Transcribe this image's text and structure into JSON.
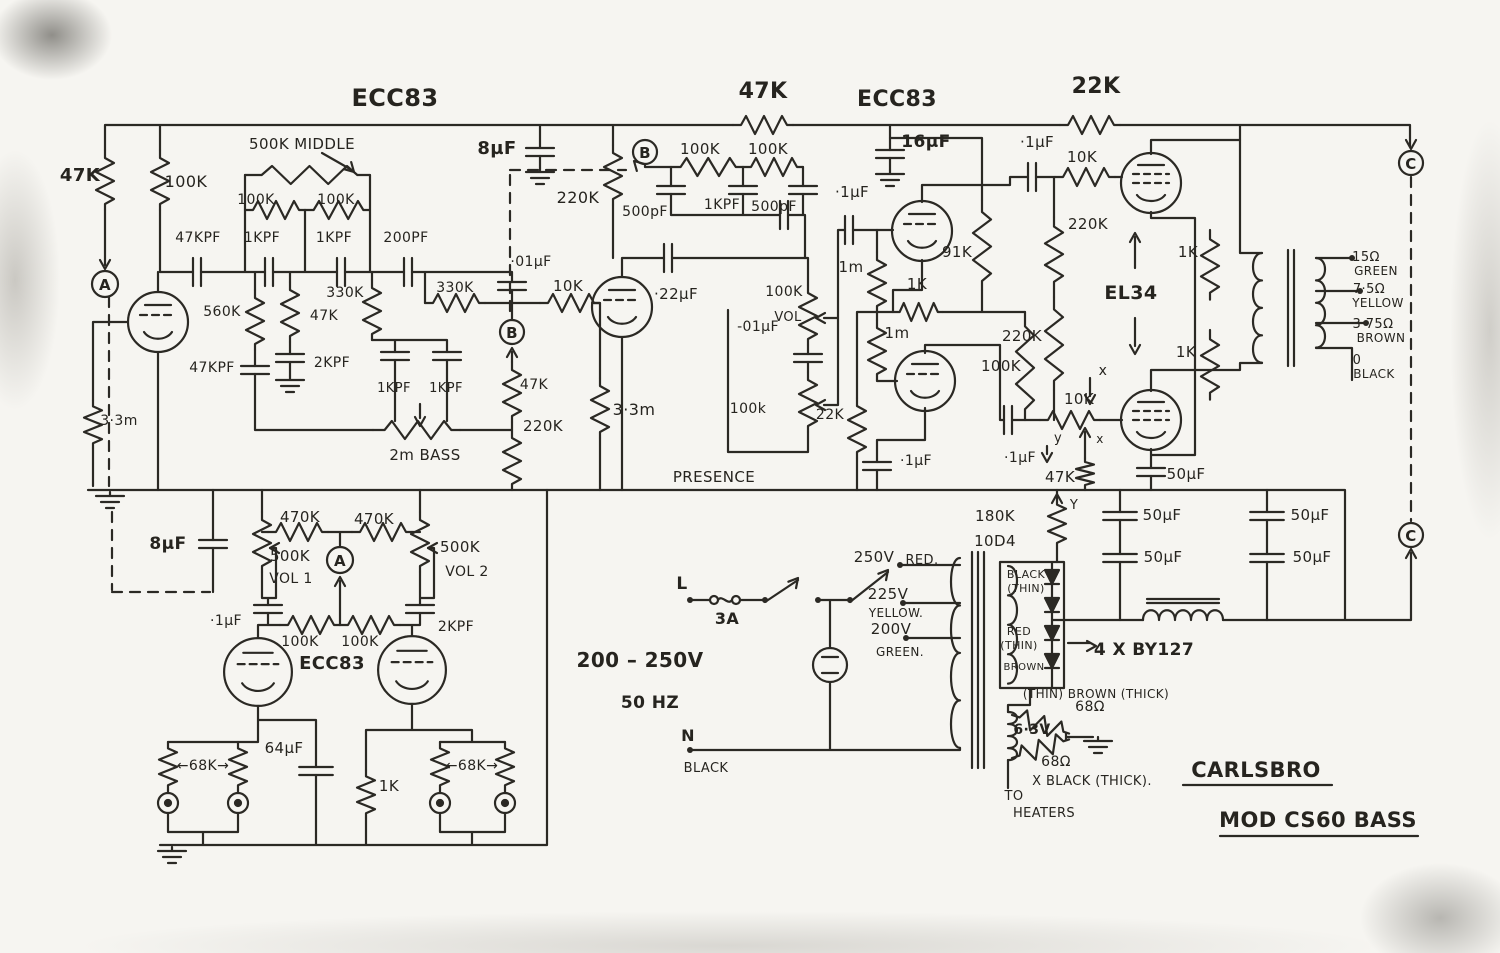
{
  "meta": {
    "drawing": "hand-drawn tube amplifier schematic",
    "brand": "CARLSBRO",
    "model": "MOD CS60 BASS"
  },
  "colors": {
    "ink": "#2b2924",
    "paper": "#f6f5f1",
    "edge_smudge": "#9a968f"
  },
  "labels": [
    {
      "n": "title-ecc83-1",
      "t": "ECC83",
      "x": 395,
      "y": 106,
      "s": 24,
      "b": 1
    },
    {
      "n": "r-47k-coupling-top",
      "t": "47K",
      "x": 763,
      "y": 98,
      "s": 22,
      "b": 1
    },
    {
      "n": "title-ecc83-2",
      "t": "ECC83",
      "x": 897,
      "y": 106,
      "s": 22,
      "b": 1
    },
    {
      "n": "r-22k-top",
      "t": "22K",
      "x": 1096,
      "y": 93,
      "s": 22,
      "b": 1
    },
    {
      "n": "r-47k-input",
      "t": "47K",
      "x": 80,
      "y": 181,
      "s": 18,
      "b": 1
    },
    {
      "n": "r-100k-v1-anode",
      "t": "100K",
      "x": 186,
      "y": 187,
      "s": 16
    },
    {
      "n": "pot-500k-middle",
      "t": "500K MIDDLE",
      "x": 302,
      "y": 149,
      "s": 15
    },
    {
      "n": "r-100k-mid-1",
      "t": "100K",
      "x": 256,
      "y": 204,
      "s": 14
    },
    {
      "n": "r-100k-mid-2",
      "t": "100K",
      "x": 336,
      "y": 204,
      "s": 14
    },
    {
      "n": "c-47kpf",
      "t": "47KPF",
      "x": 198,
      "y": 242,
      "s": 14
    },
    {
      "n": "c-1kpf-1",
      "t": "1KPF",
      "x": 262,
      "y": 242,
      "s": 14
    },
    {
      "n": "c-1kpf-2",
      "t": "1KPF",
      "x": 334,
      "y": 242,
      "s": 14
    },
    {
      "n": "c-200pf",
      "t": "200PF",
      "x": 406,
      "y": 242,
      "s": 14
    },
    {
      "n": "r-560k",
      "t": "560K",
      "x": 222,
      "y": 316,
      "s": 14
    },
    {
      "n": "r-330k-v",
      "t": "330K",
      "x": 345,
      "y": 297,
      "s": 14
    },
    {
      "n": "r-330k-h",
      "t": "330K",
      "x": 455,
      "y": 292,
      "s": 14
    },
    {
      "n": "r-47k-v1",
      "t": "47K",
      "x": 324,
      "y": 320,
      "s": 14
    },
    {
      "n": "c-47kpf-2",
      "t": "47KPF",
      "x": 212,
      "y": 372,
      "s": 14
    },
    {
      "n": "c-2kpf-1",
      "t": "2KPF",
      "x": 332,
      "y": 367,
      "s": 14
    },
    {
      "n": "c-8uf-1",
      "t": "8µF",
      "x": 497,
      "y": 154,
      "s": 18,
      "b": 1
    },
    {
      "n": "r-220k-b",
      "t": "220K",
      "x": 578,
      "y": 203,
      "s": 16
    },
    {
      "n": "c-01uf-b",
      "t": "·01µF",
      "x": 531,
      "y": 266,
      "s": 14
    },
    {
      "n": "r-10k-v2-grid",
      "t": "10K",
      "x": 568,
      "y": 291,
      "s": 15
    },
    {
      "n": "c-1kpf-3",
      "t": "1KPF",
      "x": 394,
      "y": 392,
      "s": 13
    },
    {
      "n": "c-1kpf-4",
      "t": "1KPF",
      "x": 446,
      "y": 392,
      "s": 13
    },
    {
      "n": "pot-2m-bass",
      "t": "2m BASS",
      "x": 425,
      "y": 460,
      "s": 15
    },
    {
      "n": "r-47k-b",
      "t": "47K",
      "x": 534,
      "y": 389,
      "s": 14
    },
    {
      "n": "r-220k-b2",
      "t": "220K",
      "x": 543,
      "y": 431,
      "s": 15
    },
    {
      "n": "r-3m3-input",
      "t": "3·3m",
      "x": 119,
      "y": 425,
      "s": 14
    },
    {
      "n": "r-3m3-v2",
      "t": "3·3m",
      "x": 634,
      "y": 415,
      "s": 16
    },
    {
      "n": "c-22uf",
      "t": "·22µF",
      "x": 676,
      "y": 299,
      "s": 15
    },
    {
      "n": "r-100k-b1",
      "t": "100K",
      "x": 700,
      "y": 154,
      "s": 15
    },
    {
      "n": "r-100k-b2",
      "t": "100K",
      "x": 768,
      "y": 154,
      "s": 15
    },
    {
      "n": "c-500pf-1",
      "t": "500pF",
      "x": 645,
      "y": 216,
      "s": 14
    },
    {
      "n": "c-1kpf-5",
      "t": "1KPF",
      "x": 722,
      "y": 209,
      "s": 14
    },
    {
      "n": "c-500pf-2",
      "t": "500pF",
      "x": 774,
      "y": 211,
      "s": 14
    },
    {
      "n": "c-01uf-presence",
      "t": "-01µF",
      "x": 758,
      "y": 331,
      "s": 14
    },
    {
      "n": "pot-100k-vol-upper",
      "t": "100K",
      "x": 784,
      "y": 296,
      "s": 14
    },
    {
      "n": "pot-vol-label",
      "t": "VOL",
      "x": 788,
      "y": 321,
      "s": 13
    },
    {
      "n": "pot-100k-presence",
      "t": "100k",
      "x": 748,
      "y": 413,
      "s": 14
    },
    {
      "n": "label-presence",
      "t": "PRESENCE",
      "x": 714,
      "y": 482,
      "s": 15
    },
    {
      "n": "r-22k-nfb",
      "t": "22K",
      "x": 830,
      "y": 419,
      "s": 14
    },
    {
      "n": "c-1uf-cathode",
      "t": "·1µF",
      "x": 916,
      "y": 465,
      "s": 14
    },
    {
      "n": "c-1uf-v3-grid",
      "t": "·1µF",
      "x": 852,
      "y": 197,
      "s": 15
    },
    {
      "n": "r-1m-1",
      "t": "1m",
      "x": 851,
      "y": 272,
      "s": 15
    },
    {
      "n": "r-91k",
      "t": "91K",
      "x": 957,
      "y": 257,
      "s": 15
    },
    {
      "n": "r-1k-pi",
      "t": "1K",
      "x": 917,
      "y": 289,
      "s": 15
    },
    {
      "n": "r-1m-2",
      "t": "1m",
      "x": 897,
      "y": 338,
      "s": 15
    },
    {
      "n": "c-16uf",
      "t": "16µF",
      "x": 926,
      "y": 147,
      "s": 17,
      "b": 1
    },
    {
      "n": "c-1uf-el34-1",
      "t": "·1µF",
      "x": 1037,
      "y": 147,
      "s": 15
    },
    {
      "n": "r-10k-el34-1",
      "t": "10K",
      "x": 1082,
      "y": 162,
      "s": 15
    },
    {
      "n": "r-220k-pi-1",
      "t": "220K",
      "x": 1088,
      "y": 229,
      "s": 15
    },
    {
      "n": "label-el34",
      "t": "EL34",
      "x": 1131,
      "y": 299,
      "s": 19,
      "b": 1
    },
    {
      "n": "r-220k-pi-2",
      "t": "220K",
      "x": 1022,
      "y": 341,
      "s": 15
    },
    {
      "n": "r-100k-pi",
      "t": "100K",
      "x": 1001,
      "y": 371,
      "s": 15
    },
    {
      "n": "c-1uf-el34-2",
      "t": "·1µF",
      "x": 1020,
      "y": 462,
      "s": 14
    },
    {
      "n": "pot-10k-bias",
      "t": "10K",
      "x": 1079,
      "y": 404,
      "s": 15
    },
    {
      "n": "label-x-1",
      "t": "x",
      "x": 1103,
      "y": 375,
      "s": 14
    },
    {
      "n": "label-x-2",
      "t": "x",
      "x": 1100,
      "y": 443,
      "s": 12
    },
    {
      "n": "label-y-1",
      "t": "y",
      "x": 1058,
      "y": 442,
      "s": 13
    },
    {
      "n": "r-47k-bias",
      "t": "47K",
      "x": 1060,
      "y": 482,
      "s": 15
    },
    {
      "n": "c-50uf-1",
      "t": "50µF",
      "x": 1186,
      "y": 479,
      "s": 15
    },
    {
      "n": "label-y-2",
      "t": "Y",
      "x": 1074,
      "y": 509,
      "s": 13
    },
    {
      "n": "r-180k",
      "t": "180K",
      "x": 995,
      "y": 521,
      "s": 15
    },
    {
      "n": "label-10d4",
      "t": "10D4",
      "x": 995,
      "y": 546,
      "s": 15
    },
    {
      "n": "c-50uf-2",
      "t": "50µF",
      "x": 1162,
      "y": 520,
      "s": 15
    },
    {
      "n": "c-50uf-3",
      "t": "50µF",
      "x": 1163,
      "y": 562,
      "s": 15
    },
    {
      "n": "c-50uf-4",
      "t": "50µF",
      "x": 1310,
      "y": 520,
      "s": 15
    },
    {
      "n": "c-50uf-5",
      "t": "50µF",
      "x": 1312,
      "y": 562,
      "s": 15
    },
    {
      "n": "r-1k-ot-1",
      "t": "1K",
      "x": 1188,
      "y": 257,
      "s": 15
    },
    {
      "n": "r-1k-ot-2",
      "t": "1K",
      "x": 1186,
      "y": 357,
      "s": 15
    },
    {
      "n": "tap-15ohm",
      "t": "15Ω",
      "x": 1366,
      "y": 261,
      "s": 13
    },
    {
      "n": "tap-green",
      "t": "GREEN",
      "x": 1376,
      "y": 275,
      "s": 12
    },
    {
      "n": "tap-7-5ohm",
      "t": "7·5Ω",
      "x": 1369,
      "y": 293,
      "s": 13
    },
    {
      "n": "tap-yellow",
      "t": "YELLOW",
      "x": 1378,
      "y": 307,
      "s": 12
    },
    {
      "n": "tap-3-75ohm",
      "t": "3·75Ω",
      "x": 1373,
      "y": 328,
      "s": 13
    },
    {
      "n": "tap-brown",
      "t": "BROWN",
      "x": 1381,
      "y": 342,
      "s": 12
    },
    {
      "n": "tap-0",
      "t": "0",
      "x": 1357,
      "y": 364,
      "s": 13
    },
    {
      "n": "tap-black",
      "t": "BLACK",
      "x": 1374,
      "y": 378,
      "s": 12
    },
    {
      "n": "node-c-1",
      "t": "C",
      "x": 1411,
      "y": 169,
      "s": 15,
      "b": 1
    },
    {
      "n": "node-c-2",
      "t": "C",
      "x": 1411,
      "y": 541,
      "s": 15,
      "b": 1
    },
    {
      "n": "node-a-1",
      "t": "A",
      "x": 105,
      "y": 290,
      "s": 15,
      "b": 1
    },
    {
      "n": "node-b-1",
      "t": "B",
      "x": 645,
      "y": 158,
      "s": 15,
      "b": 1
    },
    {
      "n": "node-b-2",
      "t": "B",
      "x": 512,
      "y": 338,
      "s": 15,
      "b": 1
    },
    {
      "n": "node-a-2",
      "t": "A",
      "x": 340,
      "y": 566,
      "s": 15,
      "b": 1
    },
    {
      "n": "c-8uf-2",
      "t": "8µF",
      "x": 168,
      "y": 549,
      "s": 17,
      "b": 1
    },
    {
      "n": "r-470k-1",
      "t": "470K",
      "x": 300,
      "y": 522,
      "s": 15
    },
    {
      "n": "r-470k-2",
      "t": "470K",
      "x": 374,
      "y": 524,
      "s": 15
    },
    {
      "n": "pot-500k-vol1",
      "t": "500K",
      "x": 290,
      "y": 561,
      "s": 15
    },
    {
      "n": "pot-vol1",
      "t": "VOL 1",
      "x": 291,
      "y": 583,
      "s": 14
    },
    {
      "n": "pot-500k-vol2",
      "t": "500K",
      "x": 460,
      "y": 552,
      "s": 15
    },
    {
      "n": "pot-vol2",
      "t": "VOL 2",
      "x": 467,
      "y": 576,
      "s": 14
    },
    {
      "n": "c-1uf-vol1",
      "t": "·1µF",
      "x": 226,
      "y": 625,
      "s": 14
    },
    {
      "n": "r-100k-g1",
      "t": "100K",
      "x": 300,
      "y": 646,
      "s": 14
    },
    {
      "n": "r-100k-g2",
      "t": "100K",
      "x": 360,
      "y": 646,
      "s": 14
    },
    {
      "n": "c-2kpf-2",
      "t": "2KPF",
      "x": 456,
      "y": 631,
      "s": 14
    },
    {
      "n": "title-ecc83-3",
      "t": "ECC83",
      "x": 332,
      "y": 669,
      "s": 18,
      "b": 1
    },
    {
      "n": "r-68k-left",
      "t": "←68K→",
      "x": 203,
      "y": 770,
      "s": 14
    },
    {
      "n": "r-68k-right",
      "t": "←68K→",
      "x": 472,
      "y": 770,
      "s": 14
    },
    {
      "n": "c-64uf",
      "t": "64µF",
      "x": 284,
      "y": 753,
      "s": 15
    },
    {
      "n": "r-1k-cathode",
      "t": "1K",
      "x": 389,
      "y": 791,
      "s": 15
    },
    {
      "n": "label-l",
      "t": "L",
      "x": 682,
      "y": 589,
      "s": 17,
      "b": 1
    },
    {
      "n": "label-3a",
      "t": "3A",
      "x": 727,
      "y": 624,
      "s": 16,
      "b": 1
    },
    {
      "n": "label-mains-v",
      "t": "200 – 250V",
      "x": 640,
      "y": 667,
      "s": 20,
      "b": 1
    },
    {
      "n": "label-50hz",
      "t": "50 HZ",
      "x": 650,
      "y": 708,
      "s": 17,
      "b": 1
    },
    {
      "n": "label-n",
      "t": "N",
      "x": 688,
      "y": 741,
      "s": 16,
      "b": 1
    },
    {
      "n": "label-black-mains",
      "t": "BLACK",
      "x": 706,
      "y": 772,
      "s": 13
    },
    {
      "n": "tap-250v",
      "t": "250V",
      "x": 874,
      "y": 562,
      "s": 15
    },
    {
      "n": "tap-red",
      "t": "RED.",
      "x": 922,
      "y": 564,
      "s": 13
    },
    {
      "n": "tap-225v",
      "t": "225V",
      "x": 888,
      "y": 599,
      "s": 15
    },
    {
      "n": "tap-yellow-psu",
      "t": "YELLOW.",
      "x": 896,
      "y": 617,
      "s": 12
    },
    {
      "n": "tap-200v",
      "t": "200V",
      "x": 891,
      "y": 634,
      "s": 15
    },
    {
      "n": "tap-green-psu",
      "t": "GREEN.",
      "x": 900,
      "y": 656,
      "s": 12
    },
    {
      "n": "label-black-thin",
      "t": "BLACK",
      "x": 1026,
      "y": 578,
      "s": 11
    },
    {
      "n": "label-thin-1",
      "t": "(THIN)",
      "x": 1026,
      "y": 592,
      "s": 11
    },
    {
      "n": "label-red-thin",
      "t": "RED",
      "x": 1019,
      "y": 635,
      "s": 11
    },
    {
      "n": "label-thin-2",
      "t": "(THIN)",
      "x": 1019,
      "y": 649,
      "s": 11
    },
    {
      "n": "label-brown-thin",
      "t": "BROWN",
      "x": 1024,
      "y": 670,
      "s": 10
    },
    {
      "n": "label-brown-thick",
      "t": "(THIN) BROWN (THICK)",
      "x": 1096,
      "y": 698,
      "s": 12
    },
    {
      "n": "label-by127",
      "t": "4 X BY127",
      "x": 1144,
      "y": 655,
      "s": 17,
      "b": 1
    },
    {
      "n": "r-68ohm-1",
      "t": "68Ω",
      "x": 1090,
      "y": 711,
      "s": 14
    },
    {
      "n": "label-6-3v",
      "t": "6·3V",
      "x": 1032,
      "y": 734,
      "s": 14,
      "b": 1
    },
    {
      "n": "r-68ohm-2",
      "t": "68Ω",
      "x": 1056,
      "y": 766,
      "s": 14
    },
    {
      "n": "label-black-thick",
      "t": "X BLACK (THICK).",
      "x": 1092,
      "y": 785,
      "s": 13
    },
    {
      "n": "label-to",
      "t": "TO",
      "x": 1014,
      "y": 800,
      "s": 13
    },
    {
      "n": "label-heaters",
      "t": "HEATERS",
      "x": 1044,
      "y": 817,
      "s": 13
    },
    {
      "n": "brand",
      "t": "CARLSBRO",
      "x": 1256,
      "y": 777,
      "s": 21,
      "b": 1
    },
    {
      "n": "model",
      "t": "MOD CS60 BASS",
      "x": 1318,
      "y": 827,
      "s": 21,
      "b": 1
    }
  ]
}
